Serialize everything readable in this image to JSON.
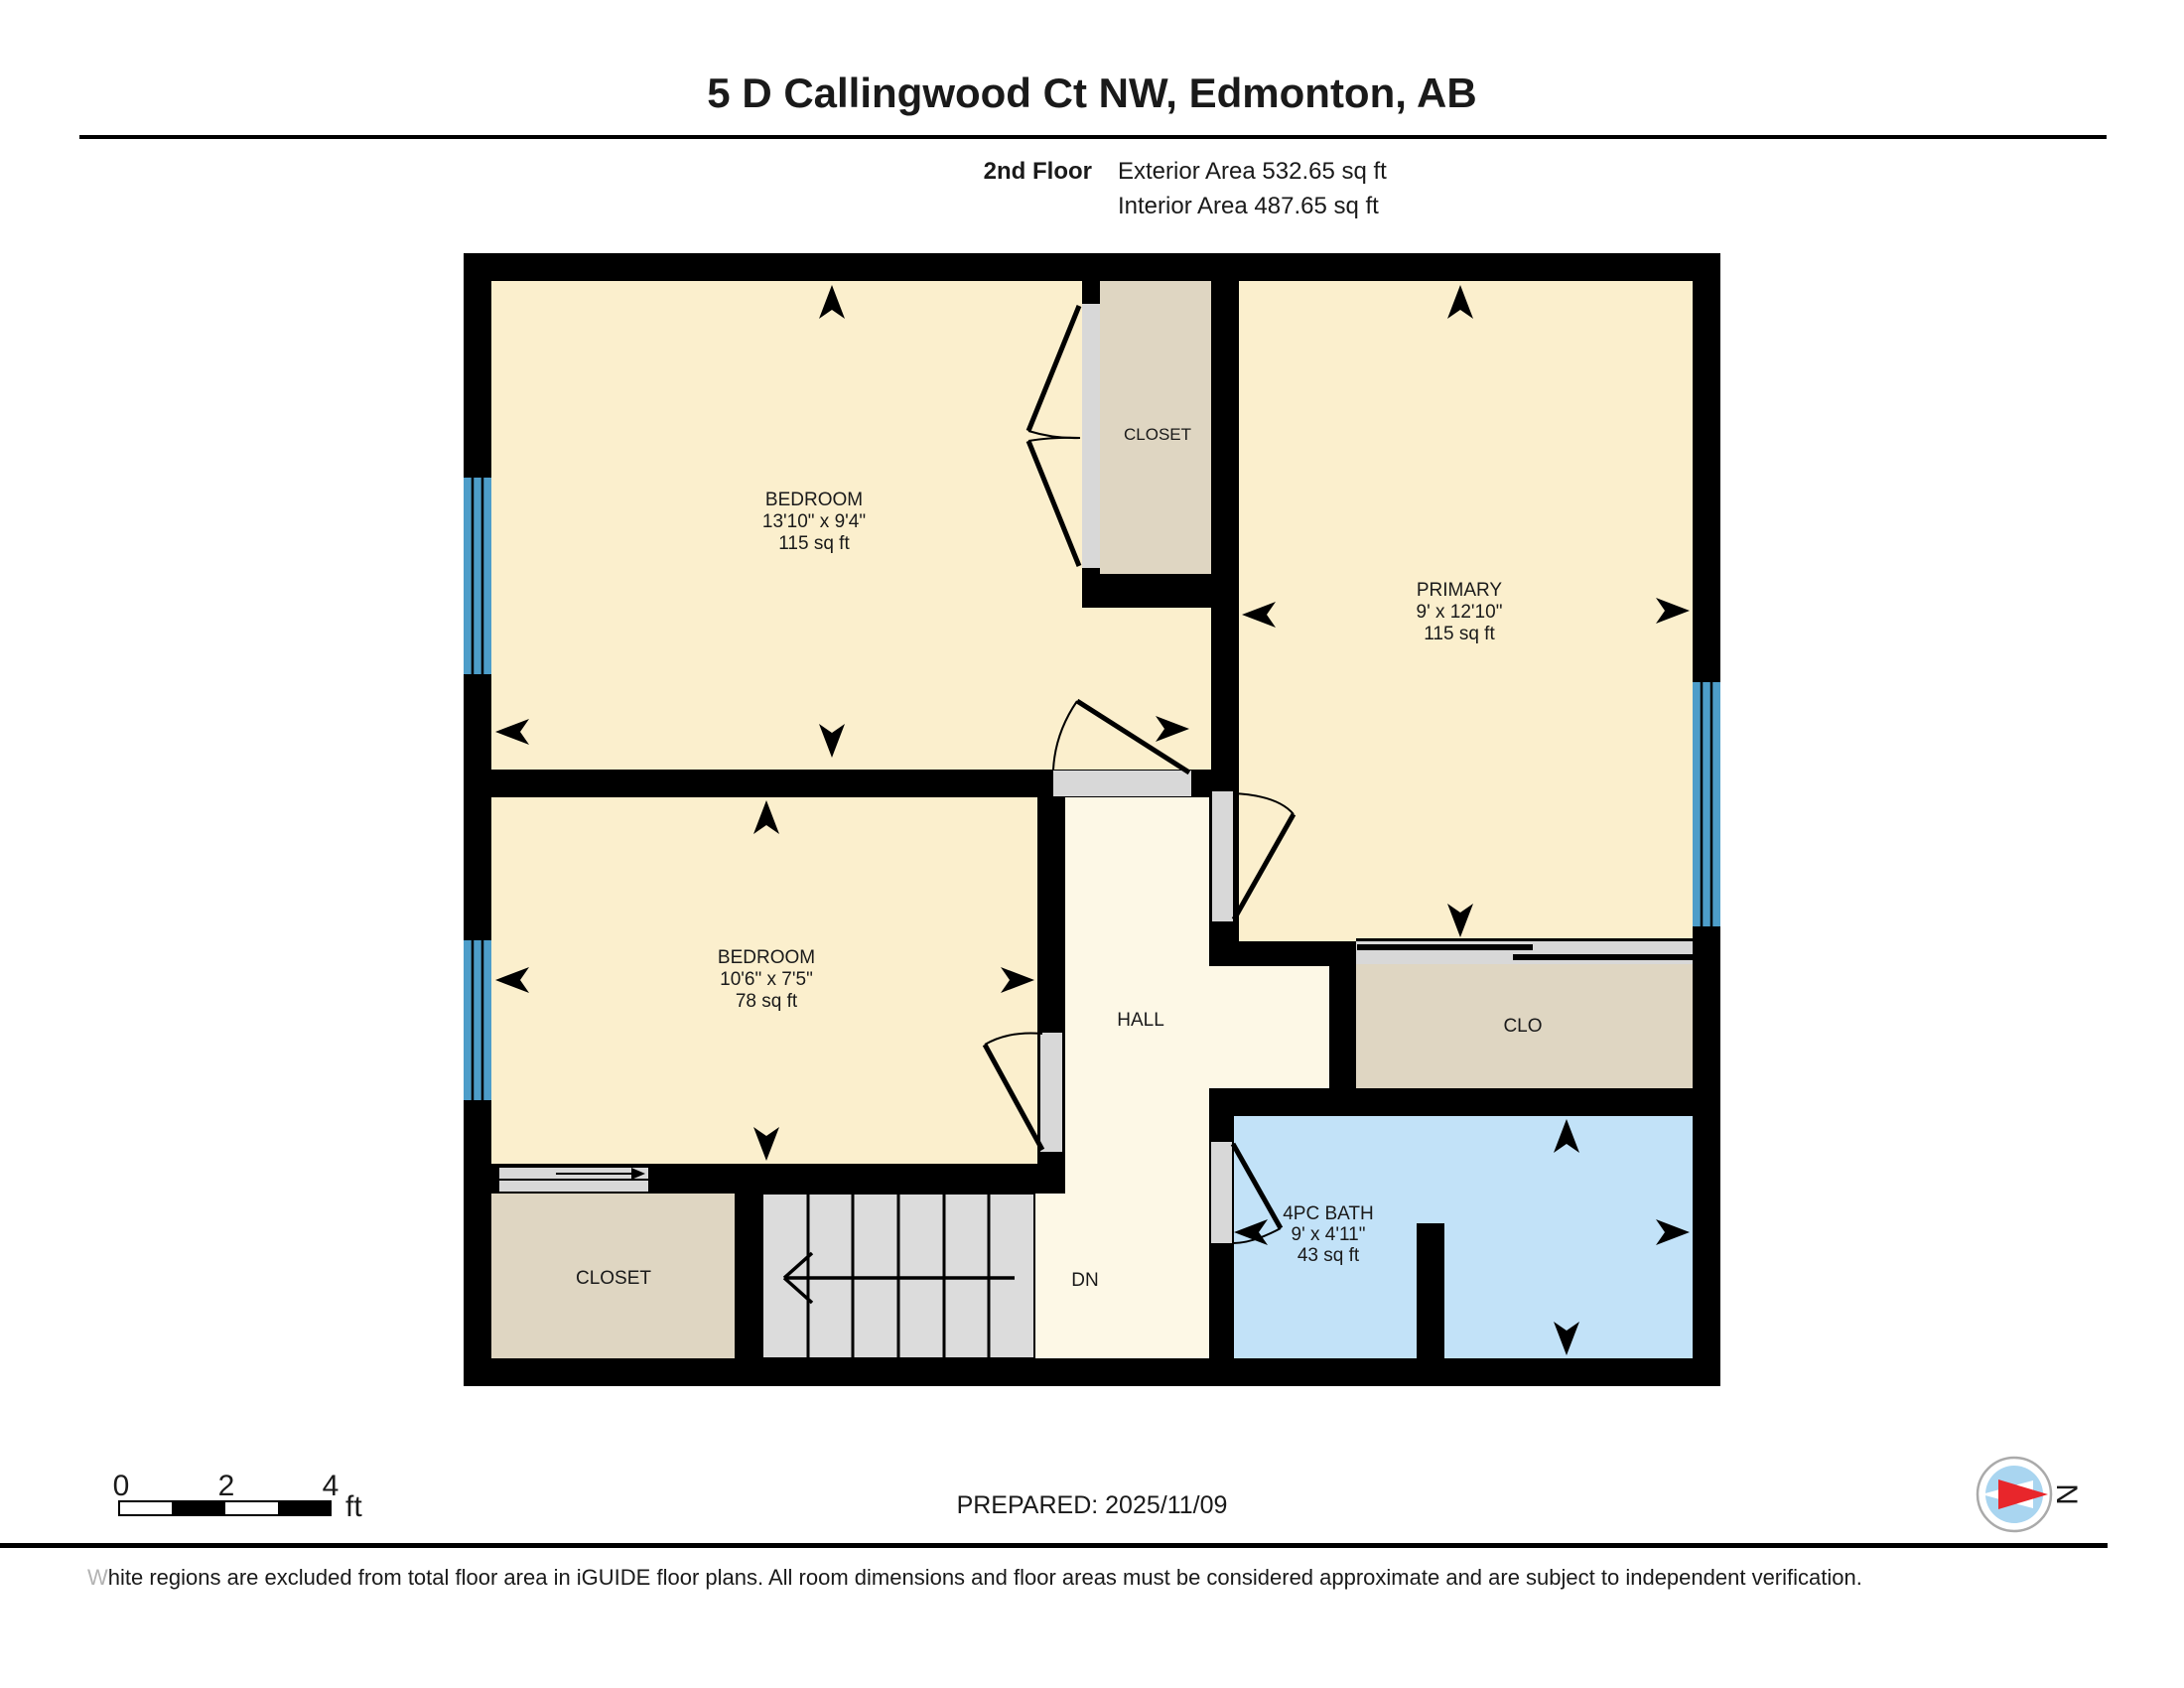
{
  "header": {
    "title": "5 D Callingwood Ct NW, Edmonton, AB",
    "floor_label": "2nd Floor",
    "exterior_area": "Exterior Area 532.65 sq ft",
    "interior_area": "Interior Area 487.65 sq ft"
  },
  "rooms": {
    "bedroom_top": {
      "name": "BEDROOM",
      "dims": "13'10\" x 9'4\"",
      "area": "115 sq ft"
    },
    "closet_top": {
      "name": "CLOSET"
    },
    "primary": {
      "name": "PRIMARY",
      "dims": "9' x 12'10\"",
      "area": "115 sq ft"
    },
    "bedroom_mid": {
      "name": "BEDROOM",
      "dims": "10'6\" x 7'5\"",
      "area": "78 sq ft"
    },
    "hall": {
      "name": "HALL"
    },
    "clo": {
      "name": "CLO"
    },
    "bath": {
      "name": "4PC BATH",
      "dims": "9' x 4'11\"",
      "area": "43 sq ft"
    },
    "closet_bottom": {
      "name": "CLOSET"
    },
    "stairs": {
      "label": "DN"
    }
  },
  "scale_bar": {
    "tick0": "0",
    "tick1": "2",
    "tick2": "4",
    "unit": "ft"
  },
  "footer": {
    "prepared": "PREPARED: 2025/11/09",
    "disclaimer_w": "W",
    "disclaimer_rest": "hite regions are excluded from total floor area in iGUIDE floor plans. All room dimensions and floor areas must be considered approximate and are subject to independent verification."
  },
  "compass": {
    "north_label": "N"
  },
  "colors": {
    "room_fill": "#FBEFCD",
    "hall_fill": "#FDF8E6",
    "closet_fill": "#DFD6C2",
    "bath_fill": "#C2E2F8",
    "window_fill": "#4D9DC9",
    "stairs_fill": "#DCDCDC",
    "door_track": "#D8D8D8",
    "wall": "#000000",
    "compass_blue": "#A9D5F0",
    "compass_red": "#E8262B"
  }
}
